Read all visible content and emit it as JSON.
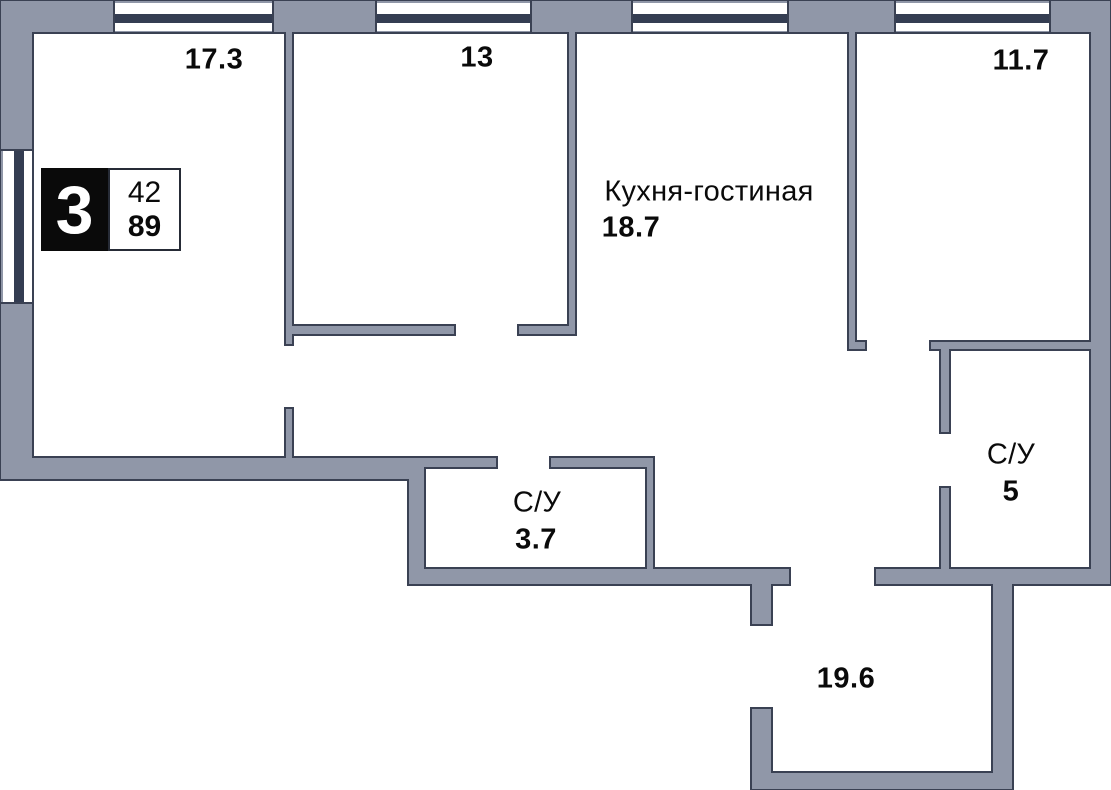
{
  "plan": {
    "badge": {
      "room_count": "3",
      "number_top": "42",
      "number_bottom": "89"
    },
    "rooms": {
      "room_17_3": {
        "area": "17.3"
      },
      "room_13": {
        "area": "13"
      },
      "kitchen_living": {
        "name": "Кухня-гостиная",
        "area": "18.7"
      },
      "room_11_7": {
        "area": "11.7"
      },
      "bathroom_small": {
        "name": "С/У",
        "area": "3.7"
      },
      "bathroom_large": {
        "name": "С/У",
        "area": "5"
      },
      "hallway": {
        "area": "19.6"
      }
    }
  },
  "colors": {
    "wall_fill": "#9097A8",
    "wall_outline": "#3A4153",
    "window_bar": "#343D52",
    "badge_bg": "#0A0A0A",
    "badge_border": "#262B36",
    "text": "#0A0A0A"
  }
}
